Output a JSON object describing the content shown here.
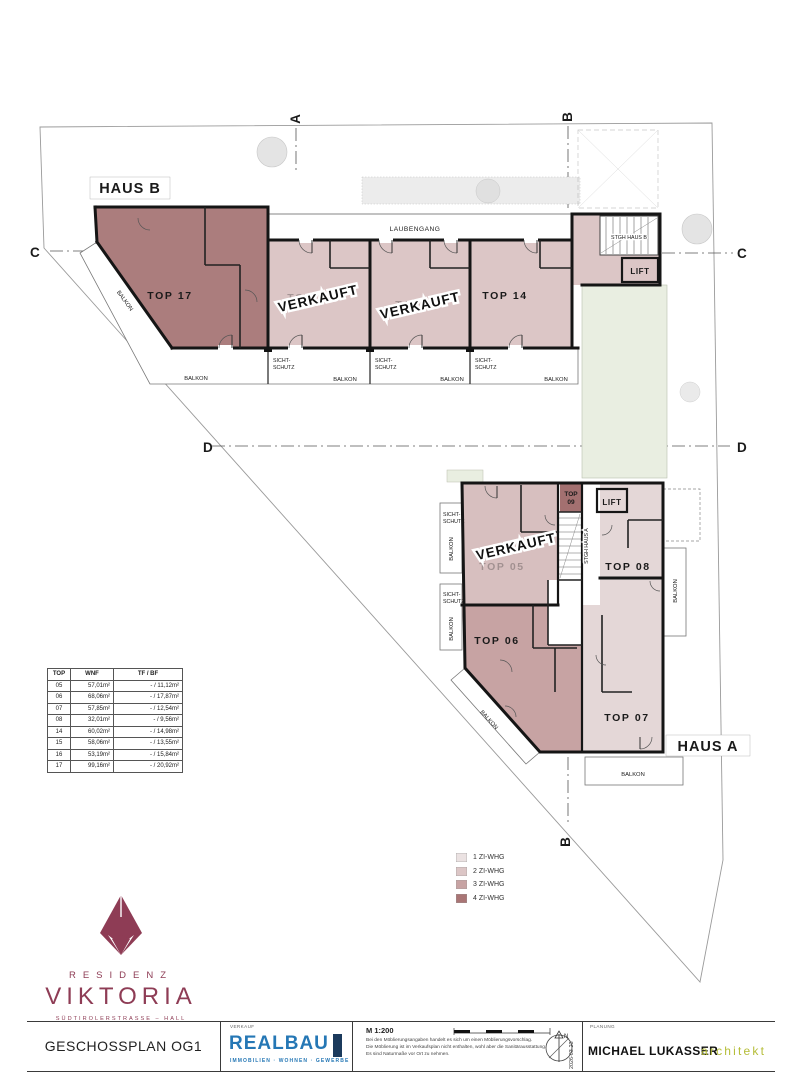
{
  "colors": {
    "zi1": "#ebe2e2",
    "zi2": "#dcc6c6",
    "zi3": "#c7a3a3",
    "zi4": "#a97575",
    "u17": "#ab7d7d",
    "u09": "#a37070",
    "u0708": "#e4d7d7",
    "u05": "#d7bfbf",
    "green": "#e9eee1",
    "brand": "#8e3c55",
    "realbau_blue": "#2577b5",
    "realbau_navy": "#1b3a5c",
    "architekt_green": "#b5bd38"
  },
  "site": {
    "haus_b": "HAUS B",
    "haus_a": "HAUS A",
    "laubengang": "LAUBENGANG",
    "stgh_haus_b": "STGH HAUS B",
    "stgh_haus_a": "STGH HAUS A",
    "lift": "LIFT",
    "verkauft": "VERKAUFT",
    "balkon": "BALKON",
    "sicht_line1": "SICHT-",
    "sicht_line2": "SCHUTZ",
    "units": {
      "top05": "TOP 05",
      "top06": "TOP 06",
      "top07": "TOP 07",
      "top08": "TOP 08",
      "top09_l1": "TOP",
      "top09_l2": "09",
      "top14": "TOP 14",
      "top15": "TOP 15",
      "top16": "TOP 16",
      "top17": "TOP 17"
    },
    "markers": {
      "a": "A",
      "b": "B",
      "c": "C",
      "d": "D"
    }
  },
  "area_table": {
    "headers": [
      "TOP",
      "WNF",
      "TF / BF"
    ],
    "rows": [
      [
        "05",
        "57,01m²",
        "- / 11,12m²"
      ],
      [
        "06",
        "68,06m²",
        "- / 17,87m²"
      ],
      [
        "07",
        "57,85m²",
        "- / 12,54m²"
      ],
      [
        "08",
        "32,01m²",
        "- / 9,56m²"
      ],
      [
        "14",
        "60,02m²",
        "- / 14,98m²"
      ],
      [
        "15",
        "58,06m²",
        "- / 13,55m²"
      ],
      [
        "16",
        "53,19m²",
        "- / 15,84m²"
      ],
      [
        "17",
        "99,16m²",
        "- / 20,92m²"
      ]
    ]
  },
  "legend": {
    "items": [
      {
        "label": "1 ZI-WHG",
        "color": "#ebe2e2"
      },
      {
        "label": "2 ZI-WHG",
        "color": "#dcc6c6"
      },
      {
        "label": "3 ZI-WHG",
        "color": "#c7a3a3"
      },
      {
        "label": "4 ZI-WHG",
        "color": "#a97575"
      }
    ]
  },
  "brand": {
    "residenz": "RESIDENZ",
    "viktoria": "VIKTORIA",
    "address": "SÜDTIROLERSTRASSE – HALL"
  },
  "footer": {
    "plan_title": "GESCHOSSPLAN OG1",
    "verkauf_label": "VERKAUF",
    "realbau": "REALBAU",
    "realbau_sub": "IMMOBILIEN · WOHNEN · GEWERBE",
    "scale": "M 1:200",
    "disclaimer_1": "Bei den Möblierungsangaben handelt es sich um einen Möblierungsvorschlag.",
    "disclaimer_2": "Die Möblierung ist im Verkaufsplan nicht enthalten, wohl aber die Sanitärausstattung.",
    "disclaimer_3": "Es sind Naturmaße vor Ort zu nehmen.",
    "date": "2026-03-23",
    "planung_label": "PLANUNG",
    "architect_name": "MICHAEL LUKASSER",
    "architect_title": "architekt",
    "north": "N"
  }
}
